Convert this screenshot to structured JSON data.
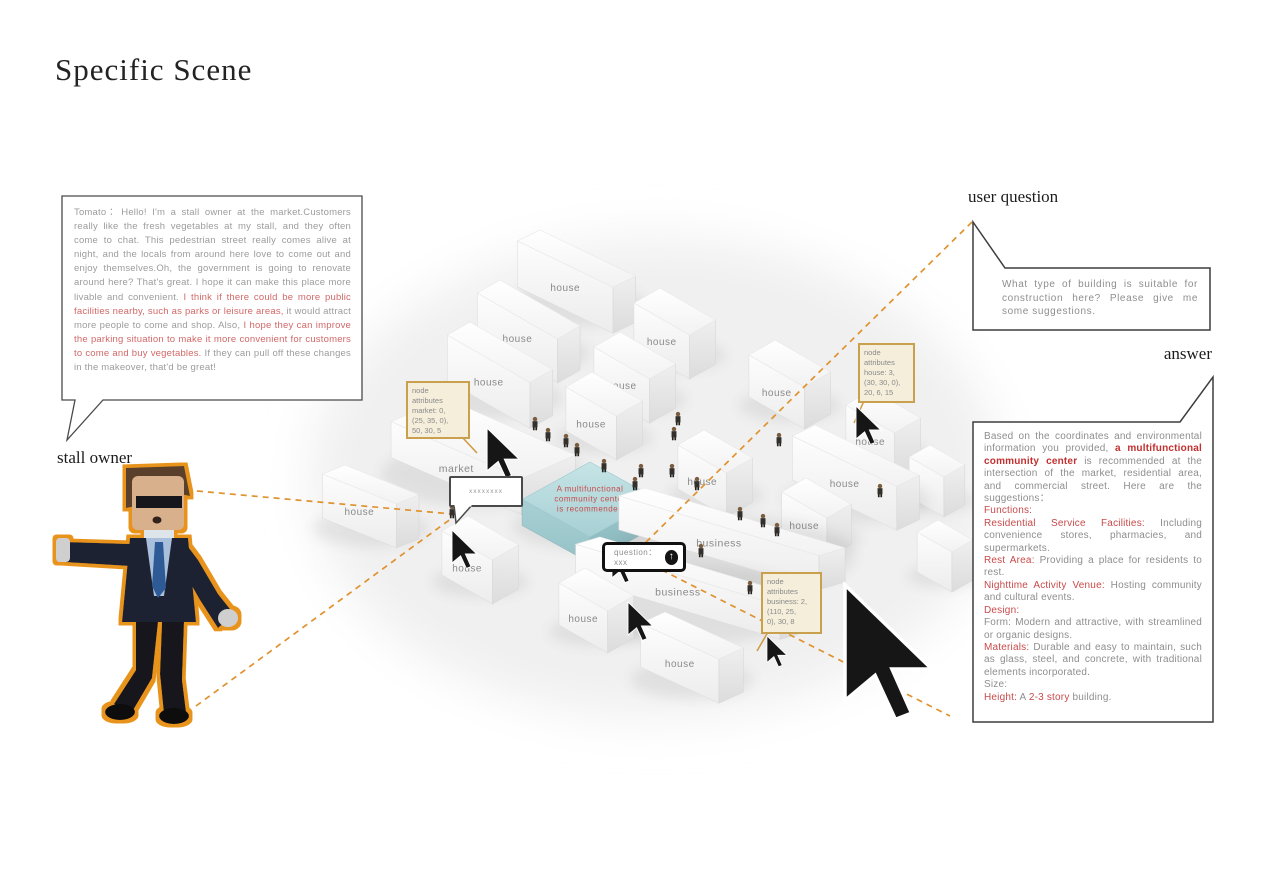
{
  "title": "Specific Scene",
  "labels": {
    "stall_owner": "stall owner",
    "user_question": "user question",
    "answer": "answer"
  },
  "colors": {
    "dash_orange": "#e0922f",
    "node_box_border": "#c9a14e",
    "highlight_red": "#c84a4a",
    "teal_building": "#aed6da"
  },
  "stall_owner_dialog": [
    {
      "t": "Tomato：Hello! I'm a stall owner at the market.Customers really like the fresh vegetables at my stall, and they often come to chat. This pedestrian street really comes alive at night, and the locals from around here love to come out and enjoy themselves.Oh, the government is going to renovate around here? That's great. I hope it can make this place more livable and convenient. ",
      "c": "g"
    },
    {
      "t": "I think if there could be more public facilities nearby, such as parks or leisure areas,",
      "c": "r"
    },
    {
      "t": " it would attract more people to come and shop. Also, ",
      "c": "g"
    },
    {
      "t": "I hope they can improve the parking situation to make it more convenient for customers to come and buy vegetables.",
      "c": "r"
    },
    {
      "t": " If they can pull off these changes in the makeover, that'd be great!",
      "c": "g"
    }
  ],
  "user_question_text": "What type of building is suitable for construction here? Please give me some suggestions.",
  "answer_runs": [
    {
      "t": "Based on the coordinates and environmental information you provided, ",
      "c": "g"
    },
    {
      "t": "a multifunctional community center",
      "c": "rb"
    },
    {
      "t": " is recommended at the intersection of the market, residential area, and commercial street. Here are the suggestions：",
      "c": "g"
    },
    {
      "t": "Functions:",
      "c": "r",
      "br": true
    },
    {
      "t": "Residential Service Facilities:",
      "c": "r",
      "br": true
    },
    {
      "t": " Including convenience stores, pharmacies, and supermarkets.",
      "c": "g"
    },
    {
      "t": "Rest Area:",
      "c": "r",
      "br": true
    },
    {
      "t": " Providing a place for residents to rest.",
      "c": "g"
    },
    {
      "t": "Nighttime Activity Venue:",
      "c": "r",
      "br": true
    },
    {
      "t": " Hosting community and cultural events.",
      "c": "g"
    },
    {
      "t": "Design:",
      "c": "r",
      "br": true
    },
    {
      "t": "Form: Modern and attractive, with streamlined or organic designs.",
      "c": "g",
      "br": true
    },
    {
      "t": "Materials:",
      "c": "r",
      "br": true
    },
    {
      "t": " Durable and easy to maintain, such as glass, steel, and concrete, with traditional elements incorporated.",
      "c": "g"
    },
    {
      "t": "Size:",
      "c": "g",
      "br": true
    },
    {
      "t": "Height:",
      "c": "r",
      "br": true
    },
    {
      "t": " A ",
      "c": "g"
    },
    {
      "t": "2-3 story",
      "c": "r"
    },
    {
      "t": " building.",
      "c": "g"
    }
  ],
  "question_input": {
    "text": "question：xxx",
    "send_icon": "arrow-up"
  },
  "chat_bubble_text": "xxxxxxxx",
  "node_boxes": [
    {
      "text": "node\nattributes\nmarket: 0,\n(25, 35, 0),\n50, 30, 5"
    },
    {
      "text": "node\nattributes\nhouse: 3,\n(30, 30, 0),\n20, 6, 15"
    },
    {
      "text": "node\nattributes\nbusiness: 2,\n(110, 25,\n0), 30, 8"
    }
  ],
  "scene": {
    "buildings": [
      {
        "label": "house",
        "t": [
          540,
          230
        ],
        "wu": 110,
        "wv": 26,
        "h": 46,
        "s": 0.42
      },
      {
        "label": "house",
        "t": [
          500,
          280
        ],
        "wu": 92,
        "wv": 26,
        "h": 44,
        "s": 0.5
      },
      {
        "label": "house",
        "t": [
          660,
          288
        ],
        "wu": 64,
        "wv": 30,
        "h": 44,
        "s": 0.5
      },
      {
        "label": "house",
        "t": [
          470,
          322
        ],
        "wu": 95,
        "wv": 26,
        "h": 46,
        "s": 0.5
      },
      {
        "label": "house",
        "t": [
          620,
          332
        ],
        "wu": 64,
        "wv": 30,
        "h": 44,
        "s": 0.5
      },
      {
        "label": "house",
        "t": [
          775,
          340
        ],
        "wu": 64,
        "wv": 30,
        "h": 42,
        "s": 0.5
      },
      {
        "label": "house",
        "t": [
          592,
          372
        ],
        "wu": 58,
        "wv": 30,
        "h": 44,
        "s": 0.5
      },
      {
        "label": "house",
        "t": [
          872,
          390
        ],
        "wu": 56,
        "wv": 30,
        "h": 44,
        "s": 0.5
      },
      {
        "label": "market",
        "t": [
          445,
          398
        ],
        "wu": 150,
        "wv": 62,
        "h": 36,
        "s": 0.38
      },
      {
        "label": "house",
        "t": [
          815,
          425
        ],
        "wu": 120,
        "wv": 26,
        "h": 44,
        "s": 0.42
      },
      {
        "label": "house",
        "t": [
          704,
          430
        ],
        "wu": 56,
        "wv": 30,
        "h": 44,
        "s": 0.5
      },
      {
        "label": "",
        "t": [
          930,
          445
        ],
        "wu": 40,
        "wv": 24,
        "h": 40,
        "s": 0.5
      },
      {
        "label": "house",
        "t": [
          345,
          465
        ],
        "wu": 85,
        "wv": 26,
        "h": 44,
        "s": 0.35
      },
      {
        "label": "",
        "t": [
          938,
          520
        ],
        "wu": 40,
        "wv": 24,
        "h": 40,
        "s": 0.5
      },
      {
        "label": "A multifunctional\ncommunity center\nis recommended",
        "t": [
          590,
          462
        ],
        "wu": 78,
        "wv": 78,
        "h": 26,
        "s": 0.48,
        "teal": true
      },
      {
        "label": "house",
        "t": [
          806,
          478
        ],
        "wu": 52,
        "wv": 28,
        "h": 40,
        "s": 0.5
      },
      {
        "label": "business",
        "t": [
          645,
          488
        ],
        "wu": 230,
        "wv": 30,
        "h": 34,
        "s": 0.26
      },
      {
        "label": "house",
        "t": [
          468,
          516
        ],
        "wu": 58,
        "wv": 30,
        "h": 44,
        "s": 0.5
      },
      {
        "label": "business",
        "t": [
          600,
          537
        ],
        "wu": 235,
        "wv": 28,
        "h": 34,
        "s": 0.26
      },
      {
        "label": "house",
        "t": [
          585,
          568
        ],
        "wu": 56,
        "wv": 30,
        "h": 42,
        "s": 0.5
      },
      {
        "label": "house",
        "t": [
          665,
          612
        ],
        "wu": 90,
        "wv": 28,
        "h": 44,
        "s": 0.4
      }
    ],
    "people": [
      [
        535,
        430
      ],
      [
        548,
        441
      ],
      [
        566,
        447
      ],
      [
        577,
        456
      ],
      [
        604,
        472
      ],
      [
        635,
        490
      ],
      [
        678,
        425
      ],
      [
        674,
        440
      ],
      [
        672,
        477
      ],
      [
        697,
        490
      ],
      [
        740,
        520
      ],
      [
        763,
        527
      ],
      [
        777,
        536
      ],
      [
        779,
        446
      ],
      [
        750,
        594
      ],
      [
        624,
        556
      ],
      [
        701,
        557
      ],
      [
        452,
        518
      ],
      [
        880,
        497
      ],
      [
        641,
        477
      ]
    ],
    "cursors": [
      {
        "x": 487,
        "y": 428,
        "s": 2.6
      },
      {
        "x": 452,
        "y": 530,
        "s": 2.0
      },
      {
        "x": 612,
        "y": 548,
        "s": 1.8
      },
      {
        "x": 856,
        "y": 406,
        "s": 2.0
      },
      {
        "x": 628,
        "y": 602,
        "s": 2.0
      },
      {
        "x": 767,
        "y": 636,
        "s": 1.6
      },
      {
        "x": 845,
        "y": 585,
        "s": 7.0,
        "big": true
      }
    ],
    "dashes": [
      [
        972,
        222,
        642,
        546
      ],
      [
        642,
        560,
        950,
        716
      ],
      [
        175,
        489,
        452,
        514
      ],
      [
        196,
        706,
        452,
        518
      ]
    ],
    "leaders": [
      [
        462,
        437,
        477,
        453
      ],
      [
        864,
        401,
        854,
        423
      ],
      [
        768,
        632,
        757,
        651
      ]
    ]
  }
}
